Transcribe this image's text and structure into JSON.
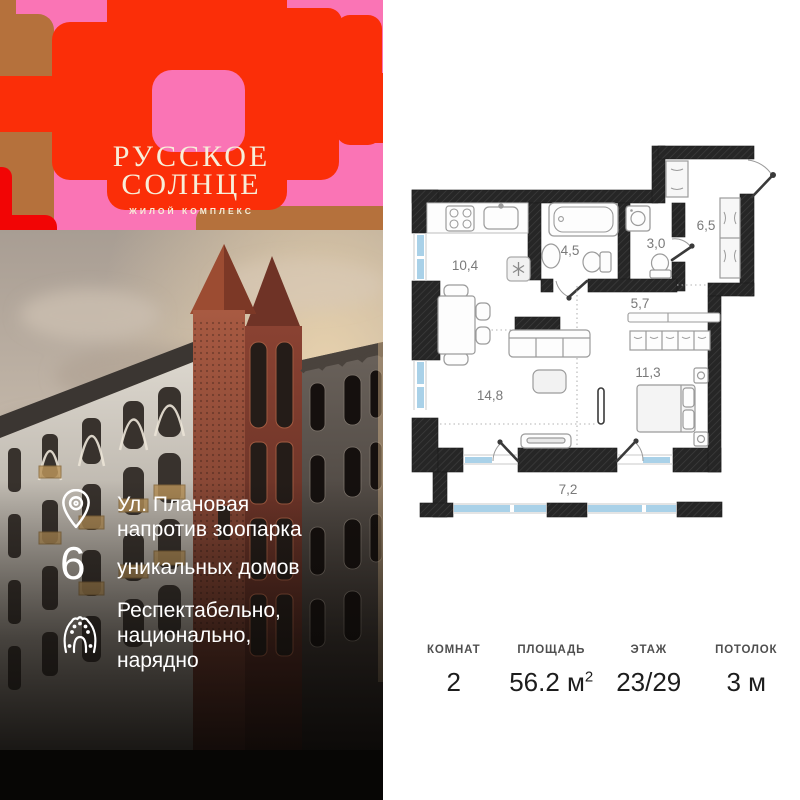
{
  "brand": {
    "title_line1": "РУССКОЕ",
    "title_line2": "СОЛНЦЕ",
    "subtitle": "ЖИЛОЙ КОМПЛЕКС"
  },
  "features": [
    {
      "icon": "location-pin-icon",
      "lines": [
        "Ул. Плановая",
        "напротив зоопарка"
      ]
    },
    {
      "icon": "digit-badge",
      "number": "6",
      "lines": [
        "уникальных домов"
      ]
    },
    {
      "icon": "kokoshnik-icon",
      "lines": [
        "Респектабельно,",
        "национально,",
        "нарядно"
      ]
    }
  ],
  "floor_plan": {
    "rooms": [
      {
        "room": "kitchen",
        "area": "10,4"
      },
      {
        "room": "bathroom",
        "area": "4,5"
      },
      {
        "room": "wc",
        "area": "3,0"
      },
      {
        "room": "hallway",
        "area": "6,5"
      },
      {
        "room": "corridor",
        "area": "5,7"
      },
      {
        "room": "living-room",
        "area": "14,8"
      },
      {
        "room": "bedroom",
        "area": "11,3"
      },
      {
        "room": "balcony",
        "area": "7,2"
      }
    ]
  },
  "stats": {
    "columns": [
      {
        "label": "КОМНАТ",
        "value": "2"
      },
      {
        "label": "ПЛОЩАДЬ",
        "value": "56.2 м",
        "sup": "2"
      },
      {
        "label": "ЭТАЖ",
        "value": "23/29"
      },
      {
        "label": "ПОТОЛОК",
        "value": "3 м"
      }
    ]
  },
  "colors": {
    "brand_pink": "#fa74b5",
    "brand_orange": "#fb2e08",
    "brand_brown": "#b5713c",
    "brand_red": "#f20505",
    "cream": "#f7eed9",
    "plan_wall": "#262626",
    "window_blue": "#a9d1e8",
    "label_gray": "#7a7a7a"
  }
}
